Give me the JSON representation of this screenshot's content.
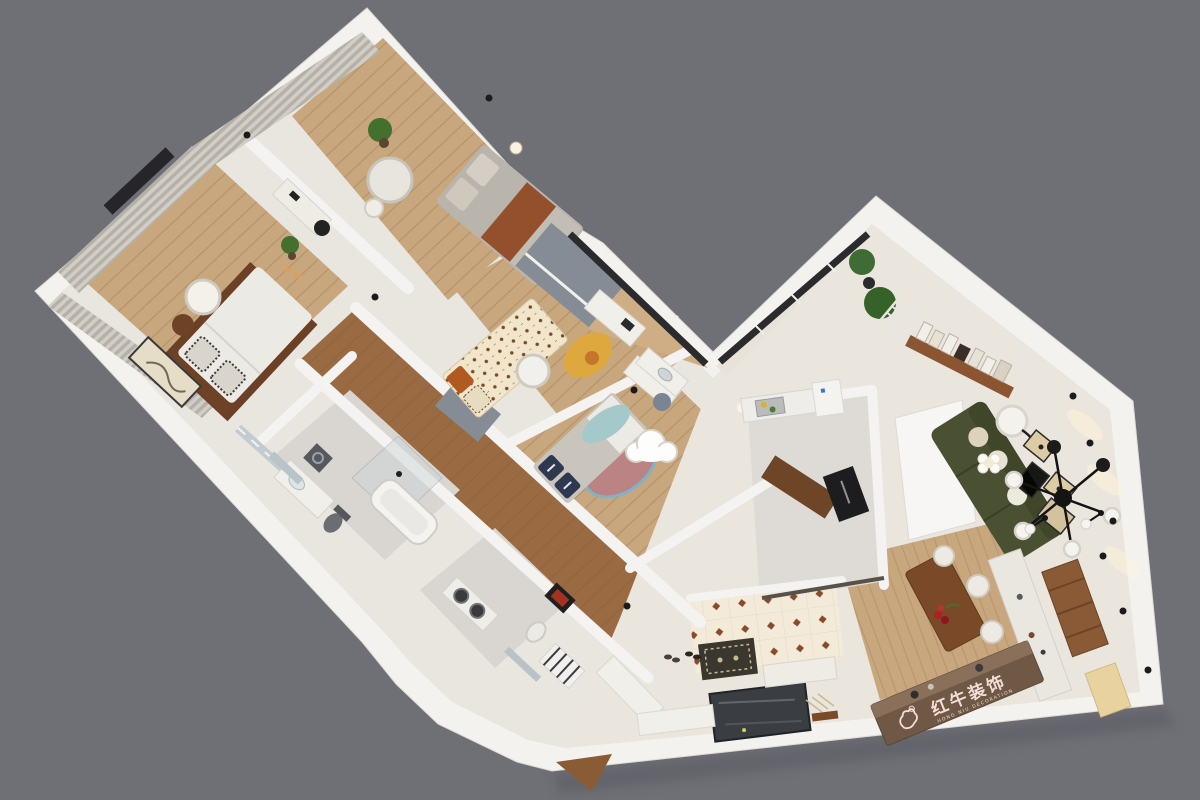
{
  "watermark": {
    "brand_cn": "红牛装饰",
    "brand_en": "HONG NIU DECORATION",
    "logo": "bull-icon"
  },
  "colors": {
    "background": "#6f6f76",
    "wall": "#f3f2ef",
    "wall_shade": "#d7d4cf",
    "plaster": "#e9e5df",
    "plaster_warm": "#eae5dd",
    "wood": "#c8a77f",
    "wood_dark": "#9a6b42",
    "kitchen_floor": "#dedbd6",
    "bath_floor": "#d9d5d0",
    "gray_cabinet": "#868c96",
    "curtain_light": "#d2cec6",
    "curtain_dark": "#b5b1a9",
    "bed_white": "#eceae4",
    "rust_blanket": "#94502c",
    "sofa_green": "#4a5132",
    "cream_pillow": "#ddd3bd",
    "walnut": "#7a4a28",
    "bench_wood": "#6f5845",
    "sideboard_white": "#eae7e1",
    "wine_cabinet": "#8a5a36",
    "appliance_black": "#1d1d1f",
    "tile_cream": "#f3ead9",
    "tile_motif": "#8a4a2a",
    "yellow_rug": "#dfa83e",
    "pink_rug": "#b98085",
    "blue_blanket": "#a5c9cb",
    "navy_pillow": "#2e3850",
    "dark_panel": "#3a3e42",
    "logo_text": "#f3ded7"
  },
  "rooms": [
    {
      "name": "master-bedroom",
      "furniture": [
        "double-bed",
        "striped-pillows",
        "walnut-headboard",
        "dark-rug",
        "pendant-lamp",
        "wall-curtains",
        "floor-artwork",
        "bedside-stool",
        "slippers"
      ]
    },
    {
      "name": "bedroom-2",
      "furniture": [
        "bed-with-rust-throw",
        "round-white-table",
        "stool",
        "desk",
        "desk-chair",
        "potted-plant",
        "table-lamp"
      ]
    },
    {
      "name": "kids-room-a",
      "furniture": [
        "bear-print-bed",
        "round-play-table",
        "yellow-rug",
        "play-chair",
        "study-desk",
        "gray-wardrobe"
      ]
    },
    {
      "name": "kids-room-b",
      "furniture": [
        "bed-navy-pillows",
        "pink-rug",
        "blue-blanket",
        "cloud-ceiling-lamp",
        "study-desk",
        "gray-desk-chair"
      ]
    },
    {
      "name": "bathroom-main",
      "furniture": [
        "vanity",
        "mirror",
        "washing-machine",
        "toilet",
        "bathtub",
        "shower-glass"
      ]
    },
    {
      "name": "bathroom-second",
      "furniture": [
        "twin-dark-basins",
        "towel-rack",
        "toilet",
        "mirror-panel",
        "leaning-frame"
      ]
    },
    {
      "name": "kitchen",
      "furniture": [
        "sink-with-vegetables",
        "refrigerator",
        "built-in-oven",
        "white-counters",
        "walnut-counter"
      ]
    },
    {
      "name": "living-room",
      "furniture": [
        "olive-green-sofa",
        "cream-pillows",
        "projection-screen",
        "sputnik-chandelier",
        "floor-lamp",
        "gallery-wall",
        "picture-ledge-books",
        "coffee-table-flowers",
        "wall-downlights"
      ]
    },
    {
      "name": "dining-room",
      "furniture": [
        "walnut-dining-table",
        "white-chairs",
        "berry-centerpiece",
        "branded-bench",
        "white-sideboard",
        "wine-cabinet",
        "wall-sconces"
      ]
    },
    {
      "name": "entry",
      "furniture": [
        "patterned-tile-floor",
        "dark-glass-panel",
        "doormat",
        "shoe-bench",
        "shoes",
        "shoe-cabinets",
        "door-wedge"
      ]
    },
    {
      "name": "hallway",
      "furniture": [
        "dark-wood-floor"
      ]
    },
    {
      "name": "balcony-corridor",
      "furniture": [
        "bay-windows",
        "palm-plants",
        "drying-rack",
        "wash-basin-counter"
      ]
    }
  ]
}
